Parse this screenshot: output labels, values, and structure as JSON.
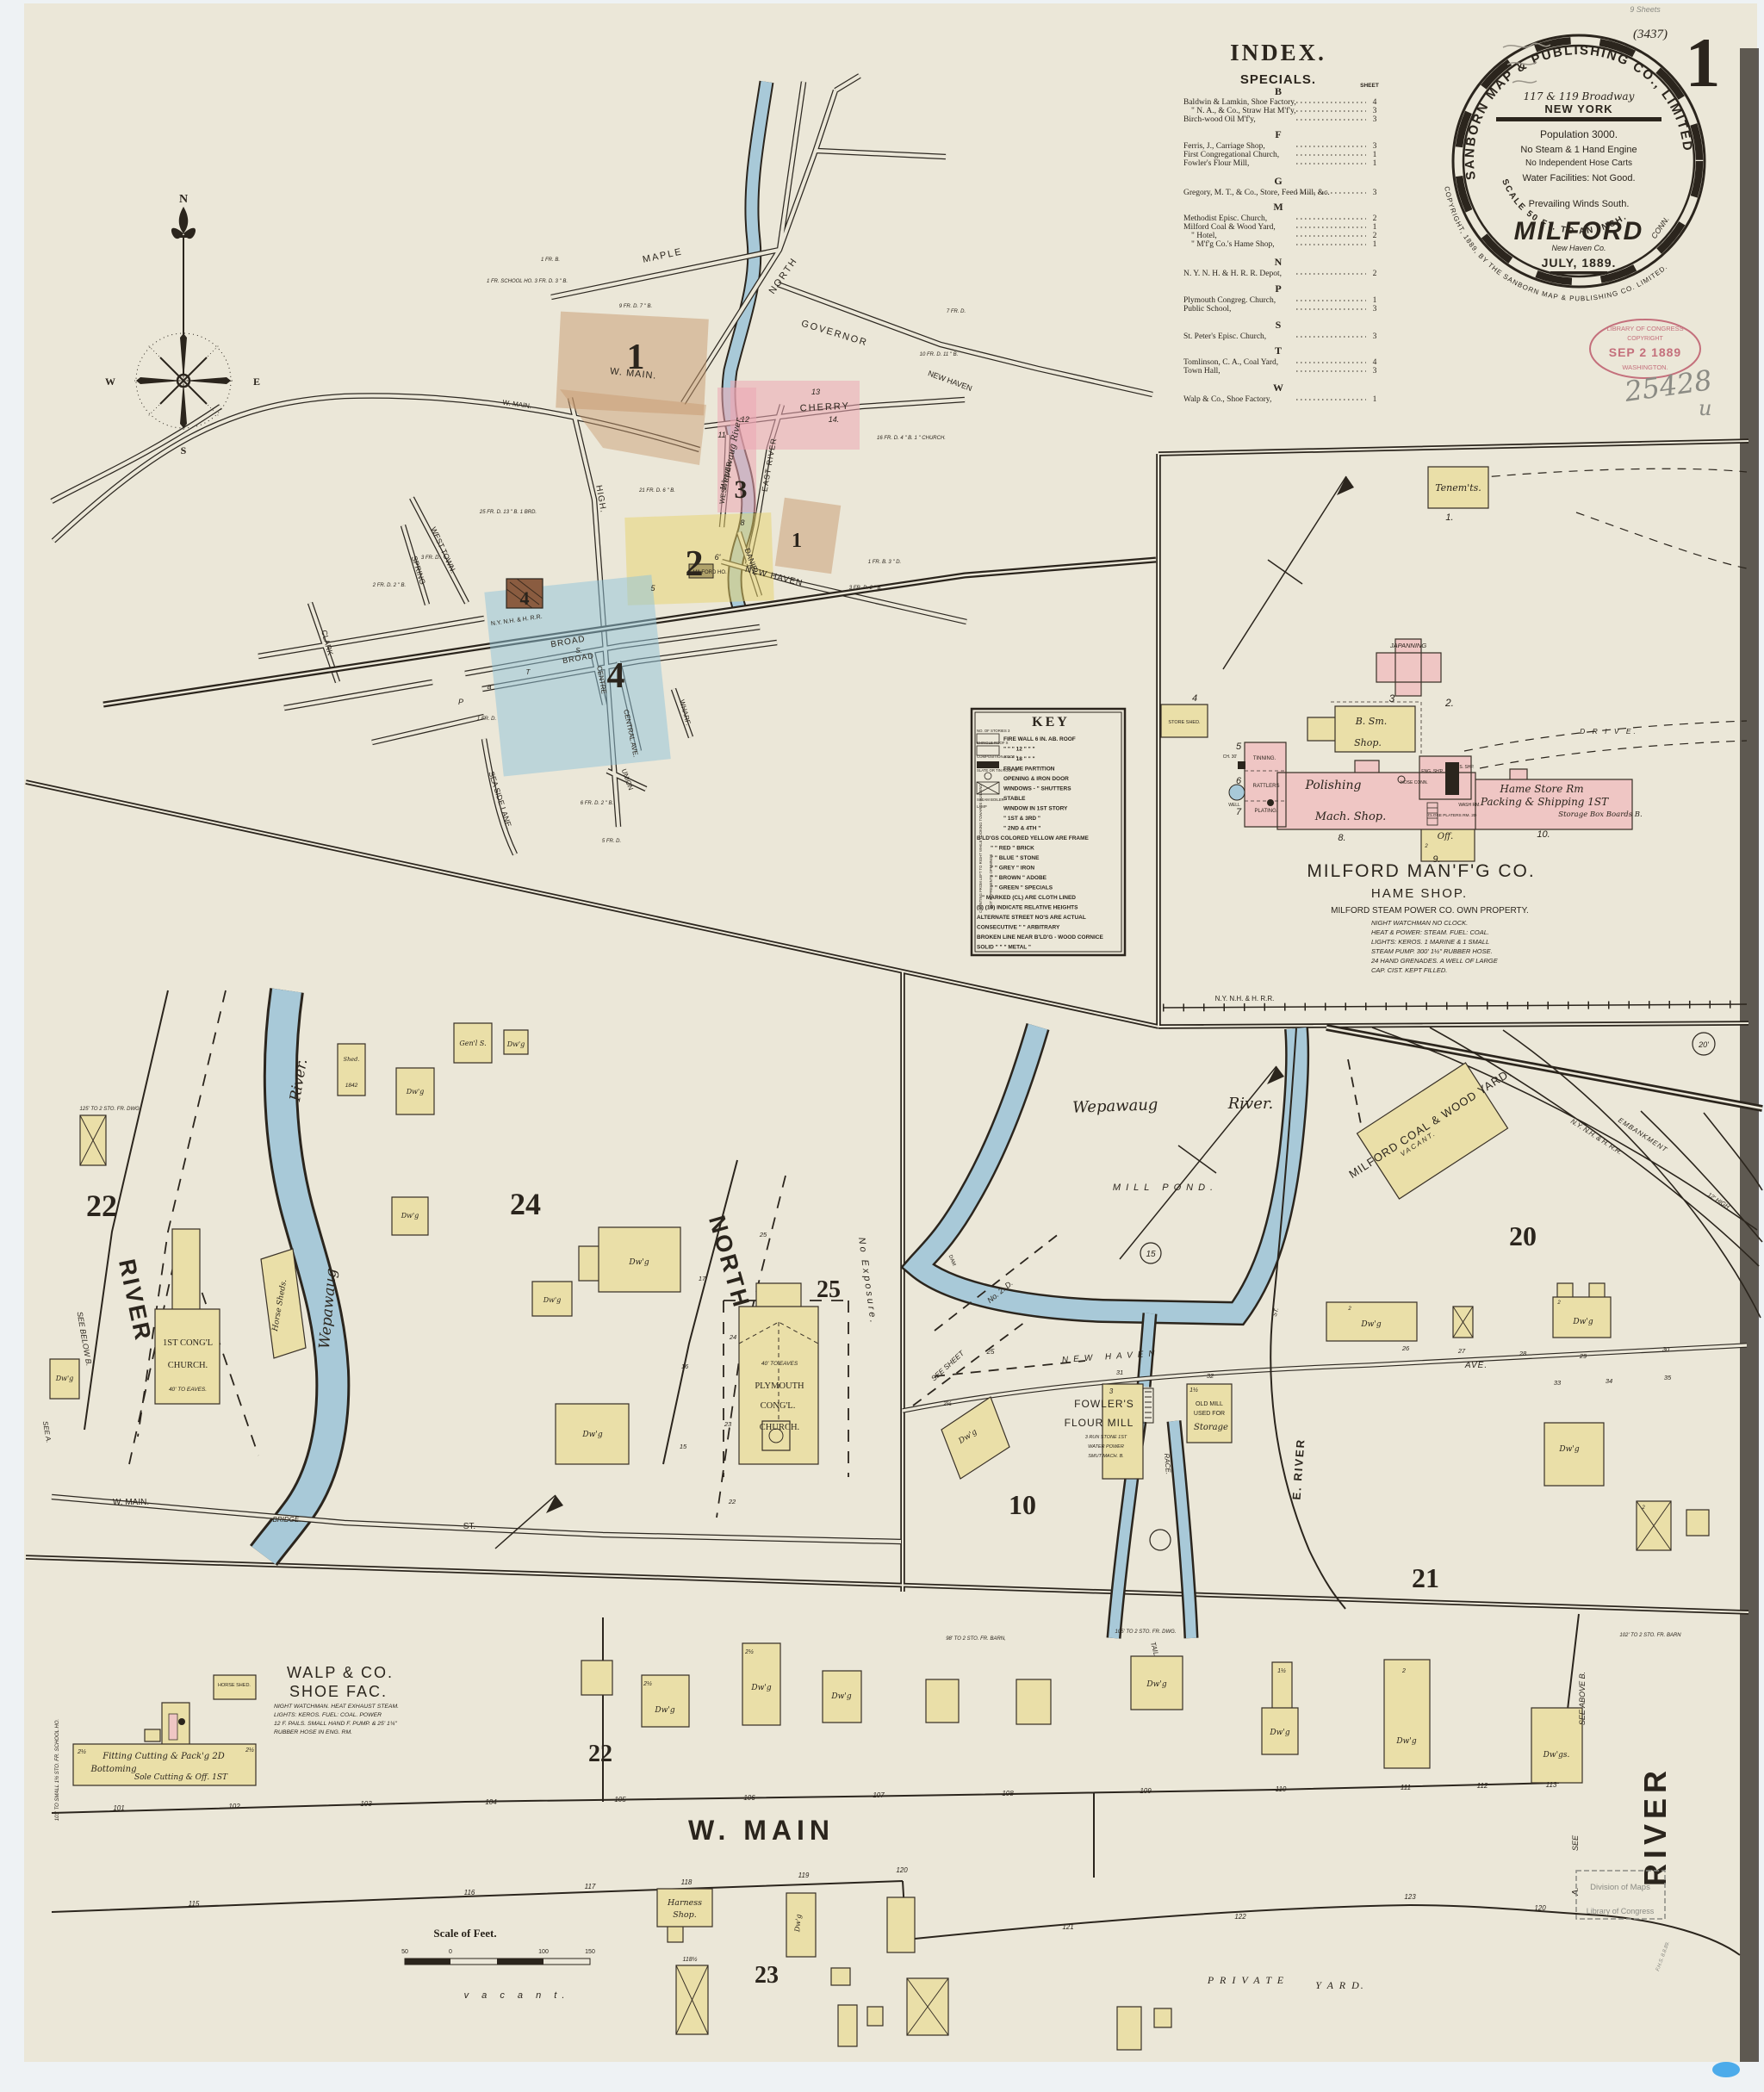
{
  "meta": {
    "sheet": "1",
    "code": "(3437)",
    "sheets": "9 Sheets",
    "accession": "25428",
    "accession2": "u",
    "surveyor": "F.H.S. 8.8.89."
  },
  "logo": {
    "ring": "SANBORN MAP & PUBLISHING CO., LIMITED",
    "address": "117 & 119 Broadway",
    "city": "NEW YORK",
    "population": "Population 3000.",
    "engine": "No Steam & 1 Hand Engine",
    "hose": "No Independent Hose Carts",
    "water": "Water Facilities: Not Good.",
    "winds": "Prevailing Winds South.",
    "town": "MILFORD",
    "state": "CONN.",
    "county": "New Haven Co.",
    "date": "JULY, 1889.",
    "scale": "SCALE 50 FT. TO AN INCH.",
    "copyright": "COPYRIGHT, 1889, BY THE SANBORN MAP & PUBLISHING CO. LIMITED."
  },
  "stamp": {
    "l1": "LIBRARY OF CONGRESS",
    "l2": "COPYRIGHT",
    "l3": "SEP 2 1889",
    "l4": "WASHINGTON."
  },
  "maps_stamp": {
    "l1": "Division of Maps",
    "l2": "Library of Congress"
  },
  "index": {
    "title": "INDEX.",
    "subtitle": "SPECIALS.",
    "sheet_col": "SHEET",
    "sections": [
      {
        "letter": "B",
        "entries": [
          {
            "name": "Baldwin & Lamkin, Shoe Factory,",
            "sheet": "4"
          },
          {
            "name": "\"    N. A., & Co., Straw Hat M'f'y,",
            "sheet": "3"
          },
          {
            "name": "Birch-wood Oil M'f'y,",
            "sheet": "3"
          }
        ]
      },
      {
        "letter": "F",
        "entries": [
          {
            "name": "Ferris, J., Carriage Shop,",
            "sheet": "3"
          },
          {
            "name": "First Congregational Church,",
            "sheet": "1"
          },
          {
            "name": "Fowler's Flour Mill,",
            "sheet": "1"
          }
        ]
      },
      {
        "letter": "G",
        "entries": [
          {
            "name": "Gregory, M. T., & Co., Store, Feed Mill, &c.",
            "sheet": "3"
          }
        ]
      },
      {
        "letter": "M",
        "entries": [
          {
            "name": "Methodist Episc. Church,",
            "sheet": "2"
          },
          {
            "name": "Milford Coal & Wood Yard,",
            "sheet": "1"
          },
          {
            "name": "\"    Hotel,",
            "sheet": "2"
          },
          {
            "name": "\"    M'f'g Co.'s Hame Shop,",
            "sheet": "1"
          }
        ]
      },
      {
        "letter": "N",
        "entries": [
          {
            "name": "N. Y. N. H. & H. R. R. Depot,",
            "sheet": "2"
          }
        ]
      },
      {
        "letter": "P",
        "entries": [
          {
            "name": "Plymouth Congreg. Church,",
            "sheet": "1"
          },
          {
            "name": "Public School,",
            "sheet": "3"
          }
        ]
      },
      {
        "letter": "S",
        "entries": [
          {
            "name": "St. Peter's Episc. Church,",
            "sheet": "3"
          }
        ]
      },
      {
        "letter": "T",
        "entries": [
          {
            "name": "Tomlinson, C. A., Coal Yard,",
            "sheet": "4"
          },
          {
            "name": "Town Hall,",
            "sheet": "3"
          }
        ]
      },
      {
        "letter": "W",
        "entries": [
          {
            "name": "Walp & Co., Shoe Factory,",
            "sheet": "1"
          }
        ]
      }
    ]
  },
  "key": {
    "title": "KEY",
    "rows": [
      "FIRE WALL 6 IN. AB. ROOF",
      "\"   \"   \"  12 \"  \"  \"",
      "\"   \"   \"  18 \"  \"  \"",
      "FRAME PARTITION",
      "OPENING & IRON DOOR",
      "WINDOWS -  \" SHUTTERS",
      "STABLE",
      "WINDOW IN 1ST STORY",
      "\"   1ST & 3RD \"",
      "\"   2ND & 4TH \"",
      "B'LD'GS COLORED YELLOW ARE FRAME",
      "\"   \"   RED \" BRICK",
      "\"   \"   BLUE \" STONE",
      "\"   \"   GREY \" IRON",
      "\"   \"   BROWN \" ADOBE",
      "\"   \"   GREEN \" SPECIALS",
      "\" MARKED (CL) ARE CLOTH LINED",
      "(5) (19) INDICATE RELATIVE HEIGHTS",
      "ALTERNATE STREET NO'S ARE ACTUAL",
      "CONSECUTIVE \"   \"   ARBITRARY",
      "BROKEN LINE NEAR B'LD'G - WOOD CORNICE",
      "SOLID \"   \"   \"   METAL \""
    ],
    "side": [
      "NO. OF STORIES 3",
      "SHINGLE ROOF X",
      "COMPOSITION ROOF +",
      "SLATE OR TIN ROOF O",
      "STEAM BOILER",
      "LAMP",
      "COUNTING FROM LEFT TO RIGHT WHILE LOOKING TOWARDS BUILDING",
      "DOT REPRESENTS OPENINGS"
    ]
  },
  "compass": {
    "n": "N",
    "e": "E",
    "w": "W",
    "s": "S"
  },
  "ov": {
    "maple": "MAPLE",
    "north": "NORTH",
    "governor": "GOVERNOR",
    "wmain": "W. MAIN.",
    "high": "HIGH.",
    "cherry": "CHERRY",
    "eriver": "EAST RIVER",
    "wriver": "WEST RIVER.",
    "daniel": "DANIEL",
    "newhaven": "NEW HAVEN",
    "clark": "CLARK",
    "spring": "SPRING",
    "westtown": "WEST TOWN.",
    "seaside": "SEA SIDE LANE.",
    "broad": "BROAD",
    "centre": "CENTRE",
    "central": "CENTRAL AVE.",
    "union": "UNION",
    "wharf": "WHARF.",
    "rr": "N.Y. N.H. & H. R.R.",
    "milford_ho": "MILFORD HO.",
    "river": "Wepawaug River.",
    "d1": "1",
    "d2": "2",
    "d3": "3",
    "d4": "4",
    "n5": "5",
    "n6": "6'",
    "n7": "7",
    "n8": "8",
    "n11": "11",
    "n12": "12",
    "n13": "13",
    "n14": "14.",
    "nT": "T",
    "nS": "S.",
    "nP": "P",
    "nA": "a",
    "note1": "9 FR. D. 7 \" B.",
    "note2": "25 FR. D. 13 \" B. 1 BRD.",
    "note3": "21 FR. D. 6 \" B.",
    "note4": "10 FR. D. 11 \" B.",
    "note5": "16 FR. D. 4 \" B. 1 \" CHURCH.",
    "note6": "7 FR. D.",
    "note7": "1 FR. SCHOOL HO. 3 FR. D. 3 \" B.",
    "note8": "2 FR. D. 2 \" B.",
    "note9": "3 FR. D.",
    "note10": "1 FR. D.",
    "note11": "5 FR. D.",
    "note12": "6 FR. D. 2 \" B.",
    "note13": "3 FR. D. 2 \" B.",
    "note14": "1 FR. B. 3 \" D.",
    "note15": "1 FR. B."
  },
  "in": {
    "title": "MILFORD MAN'F'G CO.",
    "subtitle": "HAME SHOP.",
    "own": "MILFORD STEAM POWER CO. OWN PROPERTY.",
    "n1": "NIGHT WATCHMAN NO CLOCK.",
    "n2": "HEAT & POWER: STEAM. FUEL: COAL.",
    "n3": "LIGHTS: KEROS. 1 MARINE & 1 SMALL",
    "n4": "STEAM PUMP. 300' 1½\" RUBBER HOSE.",
    "n5": "24 HAND GRENADES. A WELL OF LARGE",
    "n6": "CAP. CIST. KEPT FILLED.",
    "tenements": "Tenem'ts.",
    "japanning": "JAPANNING",
    "bsm": "B. Sm.",
    "shop": "Shop.",
    "storeshed": "STORE SHED.",
    "tinning": "TINNING.",
    "rattlers": "RATTLERS",
    "plating": "PLATING.",
    "well": "WELL",
    "ch30": "CH. 30'",
    "polishing": "Polishing",
    "machshop": "Mach. Shop.",
    "engshop": "ENG. SH'P.",
    "sshp": "S. SHP.",
    "hoseconn": "HOSE CONN.",
    "washrm": "WASH RM.",
    "closeplaters": "CLOSE PLATERS RM. 2D",
    "off": "Off.",
    "hamestore": "Hame Store Rm",
    "packing": "Packing & Shipping 1ST",
    "storagebox": "Storage Box Boards B.",
    "drive": "D R I V E.",
    "rr": "N.Y. N.H. & H. R.R.",
    "b1": "1.",
    "b2": "2.",
    "b3": "3",
    "b4": "4",
    "b5": "5",
    "b6": "6",
    "b7": "7",
    "b8": "8.",
    "b9": "9.",
    "b10": "10."
  },
  "ql": {
    "d22": "22",
    "d24": "24",
    "d25": "25",
    "river_st": "RIVER",
    "north_st": "NORTH",
    "wmain": "W. MAIN.",
    "bridge": "BRIDGE.",
    "st": "ST.",
    "see_below": "SEE BELOW B.",
    "see_a": "SEE A.",
    "no_exposure": "No Exposure.",
    "church1a": "1ST CONG'L",
    "church1b": "CHURCH.",
    "eaves40": "40' TO EAVES.",
    "horsesheds": "Horse Sheds.",
    "plymouth1": "PLYMOUTH",
    "plymouth2": "CONG'L.",
    "plymouth3": "CHURCH.",
    "eaves40b": "40' TO EAVES",
    "river": "River.",
    "wepawaug": "Wepawaug",
    "note125": "125' TO 2 STO. FR. DWG.",
    "shed": "Shed.",
    "n1842": "1842",
    "genls": "Gen'l S.",
    "l15": "15",
    "l16": "16",
    "l17": "17",
    "l22": "22",
    "l23": "23",
    "l24": "24",
    "l25": "25"
  },
  "qr": {
    "wepawaug": "Wepawaug",
    "river": "River.",
    "millpond": "MILL POND.",
    "c15": "15",
    "dam": "DAM",
    "no2d": "No. 2. D.",
    "seesheet": "SEE SHEET",
    "l25": "25",
    "newhaven": "NEW HAVEN",
    "ave": "AVE.",
    "l26": "26",
    "l27": "27",
    "l28": "28",
    "l29": "29",
    "l30": "30",
    "l31": "31",
    "l32": "32",
    "l33": "33",
    "l34": "34",
    "l35": "35",
    "fowlers1": "FOWLER'S",
    "fowlers2": "FLOUR MILL",
    "fnote1": "3 RUN STONE 1ST",
    "fnote2": "WATER POWER",
    "fnote3": "SMUT MACH. B.",
    "oldmill1": "OLD MILL",
    "oldmill2": "USED FOR",
    "oldmill3": "Storage",
    "tail": "TAIL",
    "race": "RACE.",
    "eriver": "E. RIVER",
    "st": "ST.",
    "coalyard": "MILFORD COAL & WOOD YARD.",
    "vacant": "VACANT.",
    "rr": "N.Y. N.H. & H. R.R.",
    "embankment": "EMBANKMENT",
    "high12": "12' HIGH",
    "c20": "20'",
    "d10": "10",
    "d20": "20",
    "d21": "21"
  },
  "bp": {
    "walp1": "WALP & CO.",
    "walp2": "SHOE FAC.",
    "wn1": "NIGHT WATCHMAN. HEAT EXHAUST STEAM.",
    "wn2": "LIGHTS: KEROS. FUEL: COAL. POWER",
    "wn3": "12 F. PAILS. SMALL HAND F. PUMP. & 25' 1¼\"",
    "wn4": "RUBBER HOSE IN ENG. RM.",
    "fitting": "Fitting Cutting & Pack'g 2D",
    "bottoming": "Bottoming",
    "sole": "Sole Cutting & Off. 1ST",
    "horseshed": "HORSE SHED.",
    "note103": "103' TO SMALL 1½ STO. FR. SCHOOL HO.",
    "note105": "105' TO 2 STO. FR. DWG.",
    "note98": "98' TO 2 STO. FR. BARN,",
    "note102": "102' TO 2 STO. FR. BARN",
    "wmain": "W. MAIN",
    "d22": "22",
    "d23": "23",
    "private1": "P R I V A T E",
    "private2": "Y A R D.",
    "vacant": "v a c a n t.",
    "harness1": "Harness",
    "harness2": "Shop.",
    "n118h": "118½",
    "scale_label": "Scale of Feet.",
    "s50": "50",
    "s0": "0",
    "s100": "100",
    "s150": "150",
    "see_above": "SEE ABOVE B.",
    "river_big": "RIVER",
    "see": "SEE",
    "a": "A.",
    "lots_n": [
      "101",
      "102",
      "103",
      "104",
      "105",
      "106",
      "107",
      "108",
      "109",
      "110",
      "111",
      "112",
      "113"
    ],
    "lots_s": [
      "115",
      "116",
      "117",
      "118",
      "119",
      "120",
      "121",
      "122",
      "123",
      "120"
    ]
  },
  "common": {
    "dwg": "Dw'g",
    "dwgs": "Dw'gs.",
    "two": "2",
    "twohalf": "2½",
    "onehalf": "1½",
    "one": "1",
    "three": "3"
  }
}
